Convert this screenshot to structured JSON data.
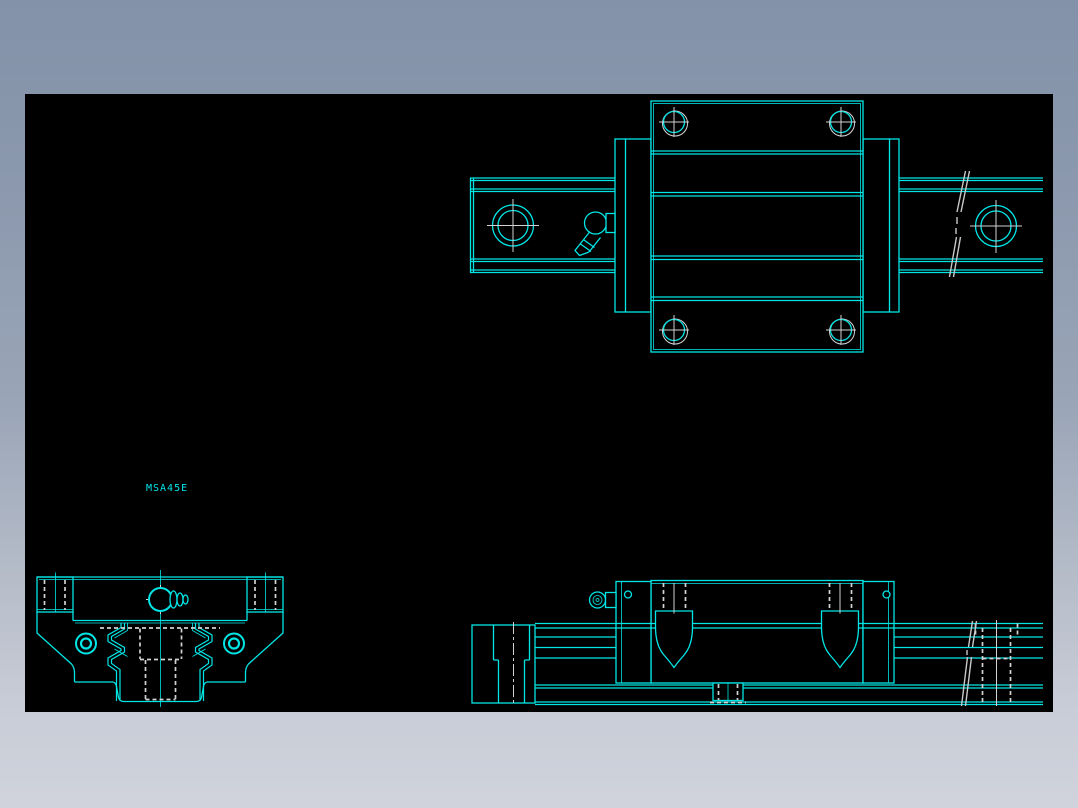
{
  "drawing": {
    "part_label": "MSA45E",
    "views": {
      "top": "plan-view",
      "front": "end-view",
      "side": "side-elevation-view"
    },
    "colors": {
      "canvas_background": "#000000",
      "line": "#00e6e6",
      "hidden_line": "#d2d2d2",
      "frame_top": "#8392a9",
      "frame_bottom": "#d0d3dc"
    }
  }
}
